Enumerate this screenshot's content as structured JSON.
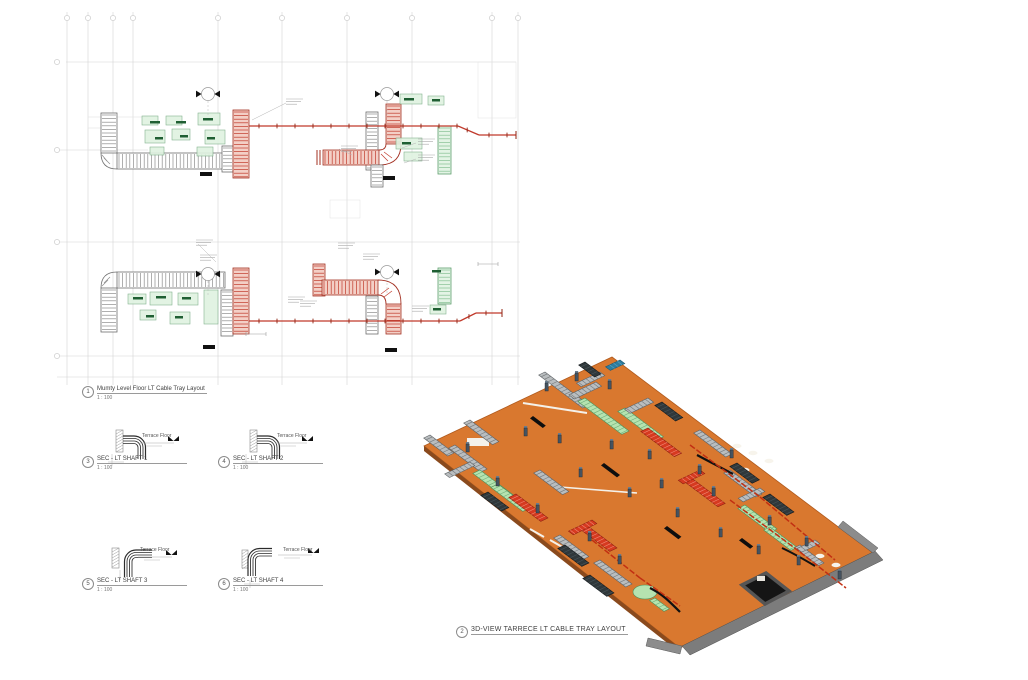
{
  "sheet": {
    "background": "#ffffff"
  },
  "colors": {
    "slab_orange": "#d9782f",
    "tray_red": "#c0392b",
    "tray_green": "#b5e3b0",
    "tray_gray": "#9aa0a4",
    "grid": "#cccccc",
    "linework": "#555555"
  },
  "plan_view": {
    "number": "1",
    "title": "Mumty Level Floor LT Cable Tray Layout",
    "scale": "1 : 100"
  },
  "view_3d": {
    "number": "2",
    "title": "3D-VIEW TARRECE LT CABLE TRAY LAYOUT"
  },
  "sections": [
    {
      "number": "3",
      "title": "SEC - LT SHAFT 1",
      "scale": "1 : 100",
      "level_label": "Terrace Floor"
    },
    {
      "number": "4",
      "title": "SEC - LT SHAFT 2",
      "scale": "1 : 100",
      "level_label": "Terrace Floor"
    },
    {
      "number": "5",
      "title": "SEC - LT SHAFT 3",
      "scale": "1 : 100",
      "level_label": "Terrace Floor"
    },
    {
      "number": "6",
      "title": "SEC - LT SHAFT 4",
      "scale": "1 : 100",
      "level_label": "Terrace Floor"
    }
  ]
}
